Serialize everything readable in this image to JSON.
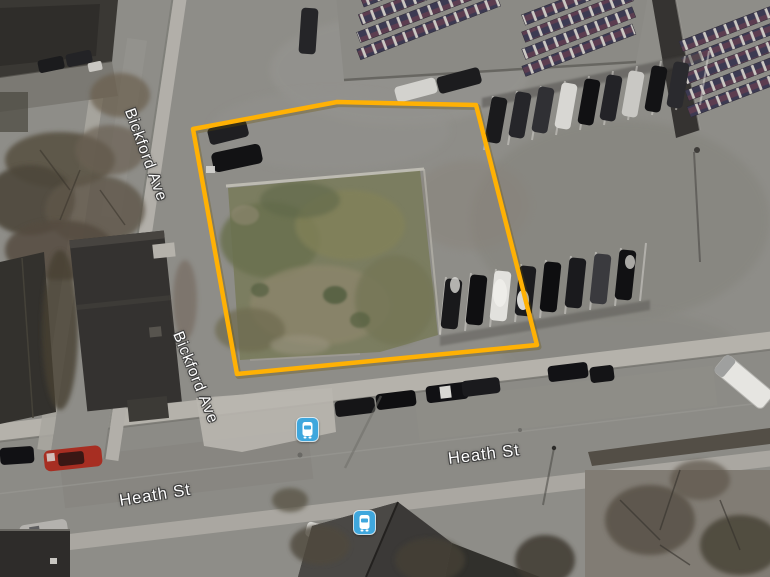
{
  "map": {
    "view_type": "satellite",
    "street_labels": [
      {
        "id": "bickford-ave-upper",
        "text": "Bickford Ave"
      },
      {
        "id": "bickford-ave-lower",
        "text": "Bickford Ave"
      },
      {
        "id": "heath-st-right",
        "text": "Heath St"
      },
      {
        "id": "heath-st-left",
        "text": "Heath St"
      }
    ],
    "transit_markers": [
      {
        "id": "bus-stop-north",
        "type": "bus-stop"
      },
      {
        "id": "bus-stop-south",
        "type": "bus-stop"
      }
    ],
    "marker_color": "#3FA7DD",
    "parcel": {
      "points": "193,129 337,102 476,105 537,345 237,374",
      "stroke_color": "#FFB104"
    }
  }
}
